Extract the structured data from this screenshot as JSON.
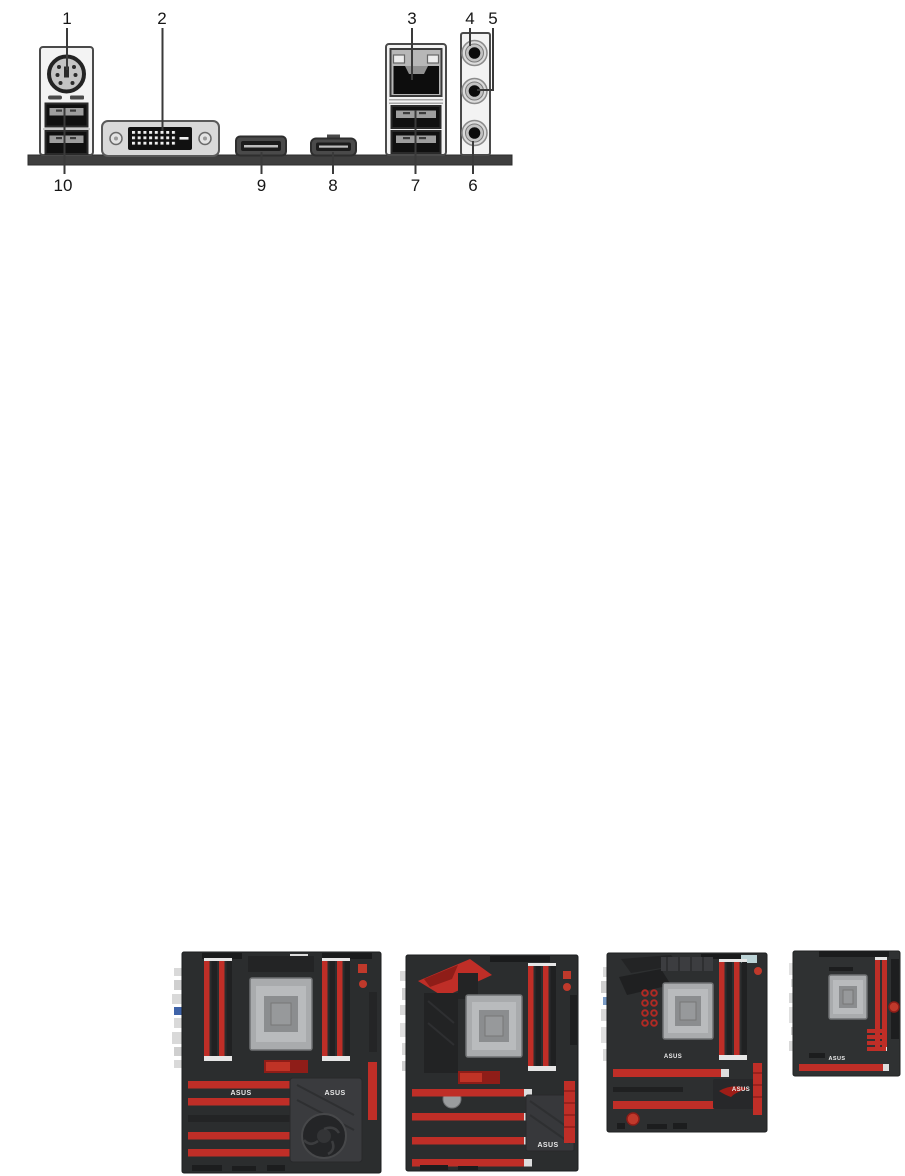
{
  "diagram": {
    "callouts": [
      "1",
      "2",
      "3",
      "4",
      "5",
      "6",
      "7",
      "8",
      "9",
      "10"
    ]
  },
  "motherboards": {
    "items": [
      {
        "asus_label": "ASUS"
      },
      {
        "asus_label": "ASUS"
      },
      {
        "asus_label": "ASUS"
      },
      {
        "asus_label": "ASUS"
      }
    ]
  },
  "colors": {
    "accent_red": "#bf2e27",
    "pcb_dark": "#2c2d2f",
    "panel_light": "#f3f3f3",
    "bracket_gray": "#3f3f3f"
  }
}
